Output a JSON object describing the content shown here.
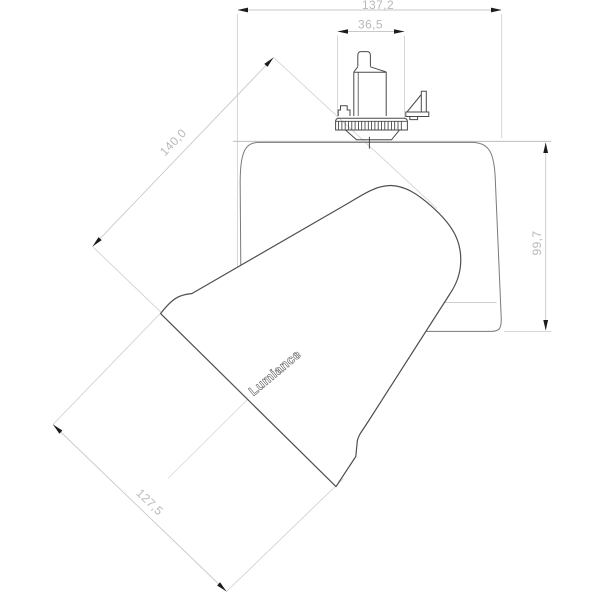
{
  "drawing": {
    "brand_label": "Lumiance",
    "dimensions": {
      "overall_width": "137,2",
      "adapter_width": "36,5",
      "housing_height": "99,7",
      "overall_length": "140,0",
      "head_diameter": "127,5"
    },
    "colors": {
      "object_line": "#4e4e4e",
      "housing_line": "#777777",
      "dimension_line": "#c9c9c9",
      "dimension_text": "#b9b9b9",
      "arrowhead": "#1c1c1c",
      "background": "#ffffff"
    }
  }
}
